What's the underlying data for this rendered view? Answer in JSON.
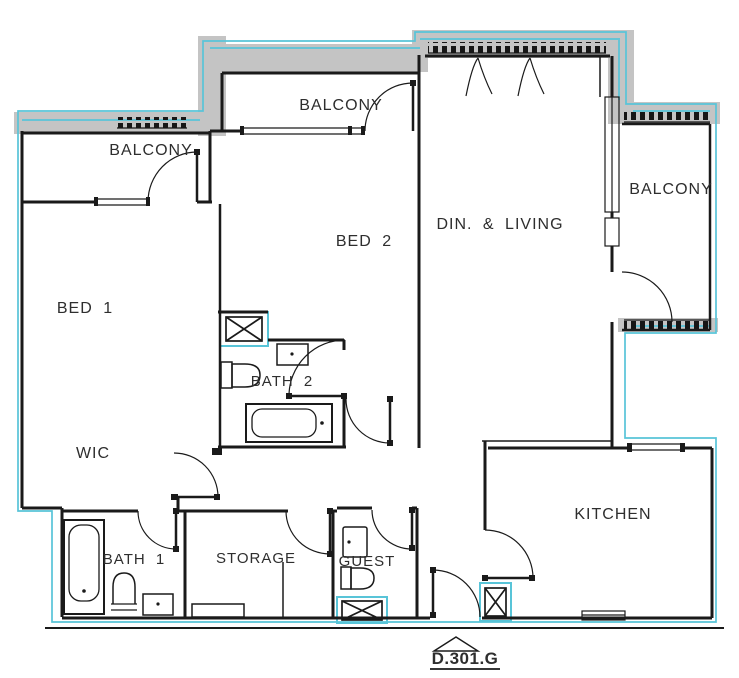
{
  "floor_plan": {
    "unit_label": "D.301.G",
    "labels": {
      "balcony_left": "BALCONY",
      "balcony_middle": "BALCONY",
      "balcony_right": "BALCONY",
      "bed_1": "BED 1",
      "bed_2": "BED 2",
      "dining_living": "DIN. & LIVING",
      "wic": "WIC",
      "bath_1": "BATH 1",
      "bath_2": "BATH 2",
      "storage": "STORAGE",
      "guest": "GUEST",
      "kitchen": "KITCHEN"
    },
    "colors": {
      "walls": "#1a1a1a",
      "highlight_cyan": "#58c4d8",
      "exterior_gray": "#c4c4c4",
      "background": "#ffffff"
    }
  }
}
